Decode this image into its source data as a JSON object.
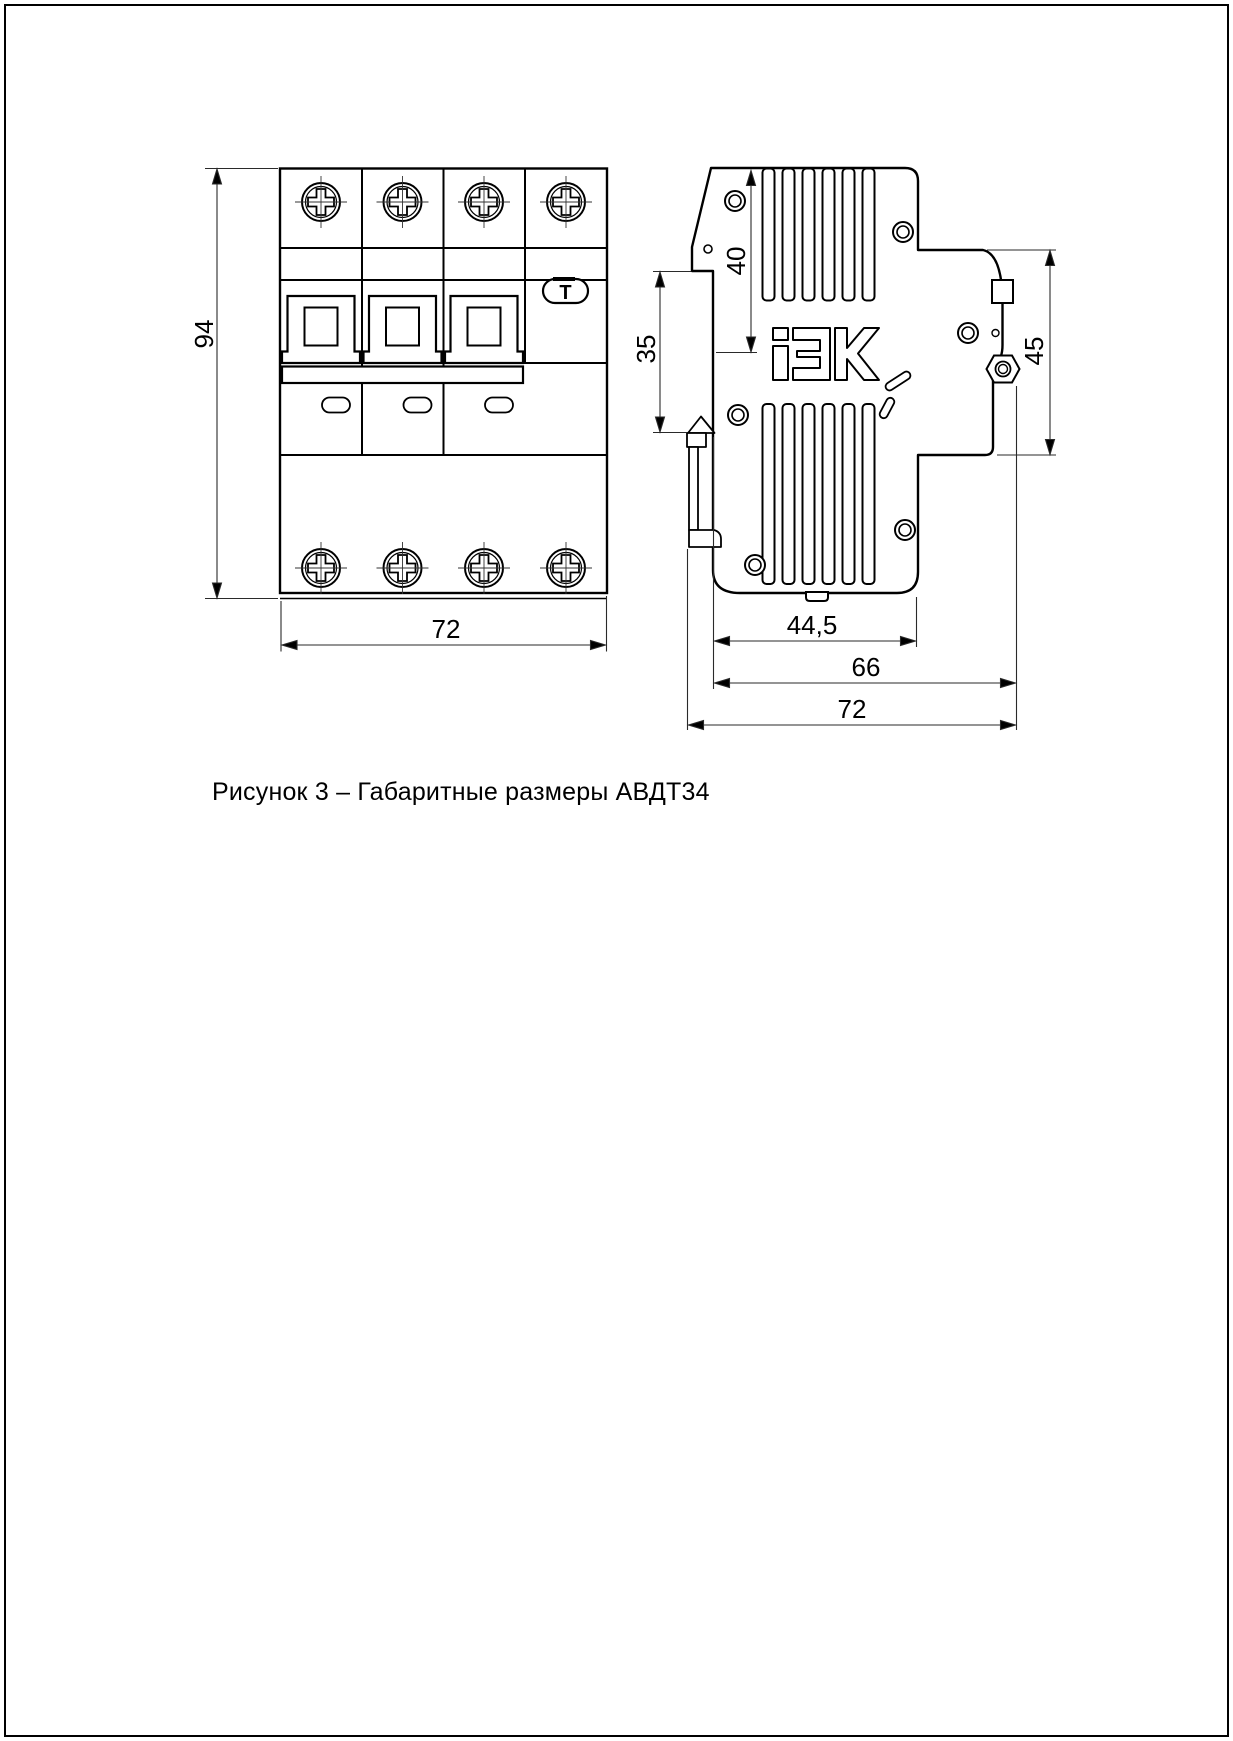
{
  "page": {
    "caption": "Рисунок 3 – Габаритные размеры АВДТ34",
    "background": "#ffffff",
    "line_color": "#000000"
  },
  "figure": {
    "type": "technical-drawing",
    "product": "АВДТ34",
    "views": {
      "front": {
        "label": "front-view",
        "poles": 4,
        "test_button_label": "Т",
        "dimensions": {
          "height_mm": "94",
          "width_mm": "72"
        }
      },
      "side": {
        "label": "side-view",
        "logo_text": "iEK",
        "dimensions": {
          "top_to_stop_mm": "40",
          "din_rail_mm": "35",
          "front_face_mm": "45",
          "body_depth_mm": "44,5",
          "depth_no_clip_mm": "66",
          "total_depth_mm": "72"
        }
      }
    }
  }
}
